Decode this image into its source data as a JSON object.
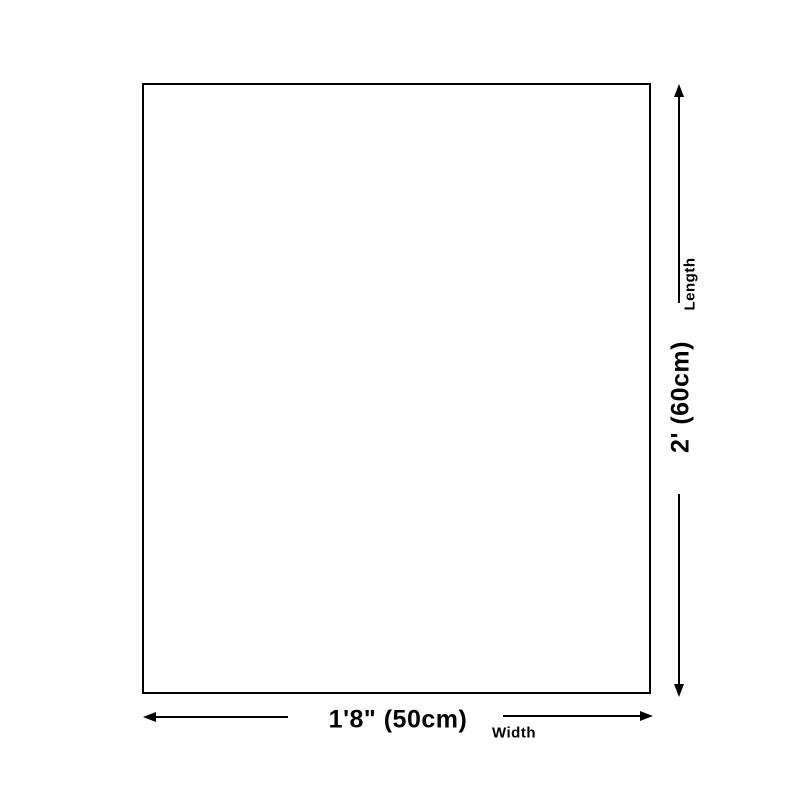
{
  "diagram": {
    "type": "product-dimension-diagram",
    "colors": {
      "background": "#ffffff",
      "line": "#000000",
      "text": "#000000",
      "box_border": "#000000",
      "box_fill": "#ffffff"
    },
    "length": {
      "label": "Length",
      "value": "2' (60cm)"
    },
    "width": {
      "label": "Width",
      "value": "1'8\" (50cm)"
    }
  }
}
